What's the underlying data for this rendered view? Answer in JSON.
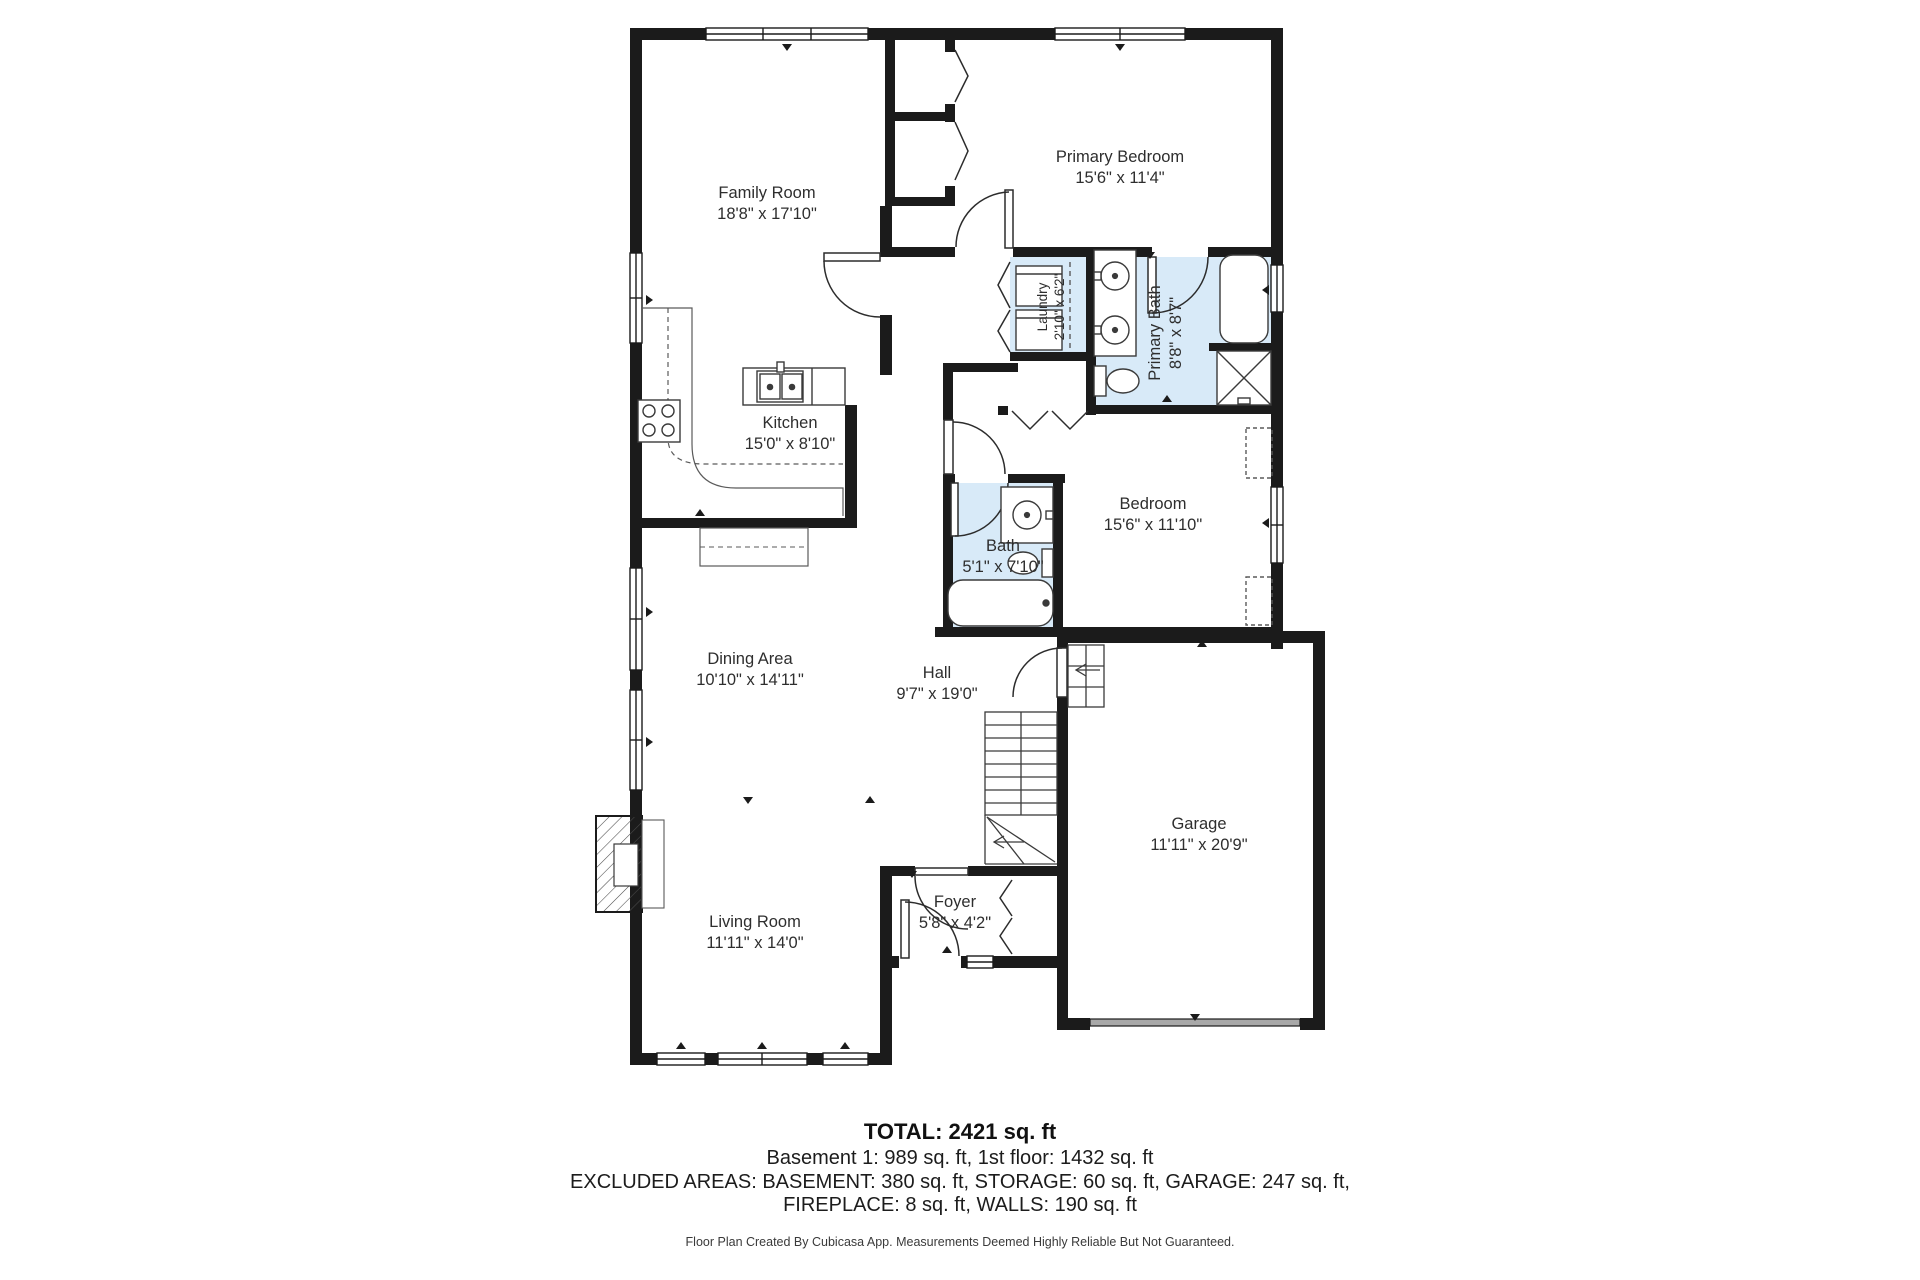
{
  "plan": {
    "colors": {
      "wall": "#1b1b1b",
      "wet_room_fill": "#d8eaf8",
      "fixture_stroke": "#3a3a3a",
      "label_color": "#2e2e2e"
    },
    "rooms": [
      {
        "id": "family-room",
        "name": "Family Room",
        "dims": "18'8\" x 17'10\""
      },
      {
        "id": "primary-bedroom",
        "name": "Primary Bedroom",
        "dims": "15'6\" x 11'4\""
      },
      {
        "id": "laundry",
        "name": "Laundry",
        "dims": "2'10\" x 6'2\""
      },
      {
        "id": "primary-bath",
        "name": "Primary Bath",
        "dims": "8'8\" x 8'7\""
      },
      {
        "id": "kitchen",
        "name": "Kitchen",
        "dims": "15'0\" x 8'10\""
      },
      {
        "id": "bedroom",
        "name": "Bedroom",
        "dims": "15'6\" x 11'10\""
      },
      {
        "id": "bath",
        "name": "Bath",
        "dims": "5'1\" x 7'10\""
      },
      {
        "id": "dining-area",
        "name": "Dining Area",
        "dims": "10'10\" x 14'11\""
      },
      {
        "id": "hall",
        "name": "Hall",
        "dims": "9'7\" x 19'0\""
      },
      {
        "id": "garage",
        "name": "Garage",
        "dims": "11'11\" x 20'9\""
      },
      {
        "id": "foyer",
        "name": "Foyer",
        "dims": "5'8\" x 4'2\""
      },
      {
        "id": "living-room",
        "name": "Living Room",
        "dims": "11'11\" x 14'0\""
      }
    ],
    "summary": {
      "total": "TOTAL: 2421 sq. ft",
      "floors": "Basement 1: 989 sq. ft, 1st floor: 1432 sq. ft",
      "excluded_line1": "EXCLUDED AREAS: BASEMENT: 380 sq. ft, STORAGE: 60 sq. ft, GARAGE: 247 sq. ft,",
      "excluded_line2": "FIREPLACE: 8 sq. ft, WALLS: 190 sq. ft"
    },
    "footer": "Floor Plan Created By Cubicasa App. Measurements Deemed Highly Reliable But Not Guaranteed."
  }
}
